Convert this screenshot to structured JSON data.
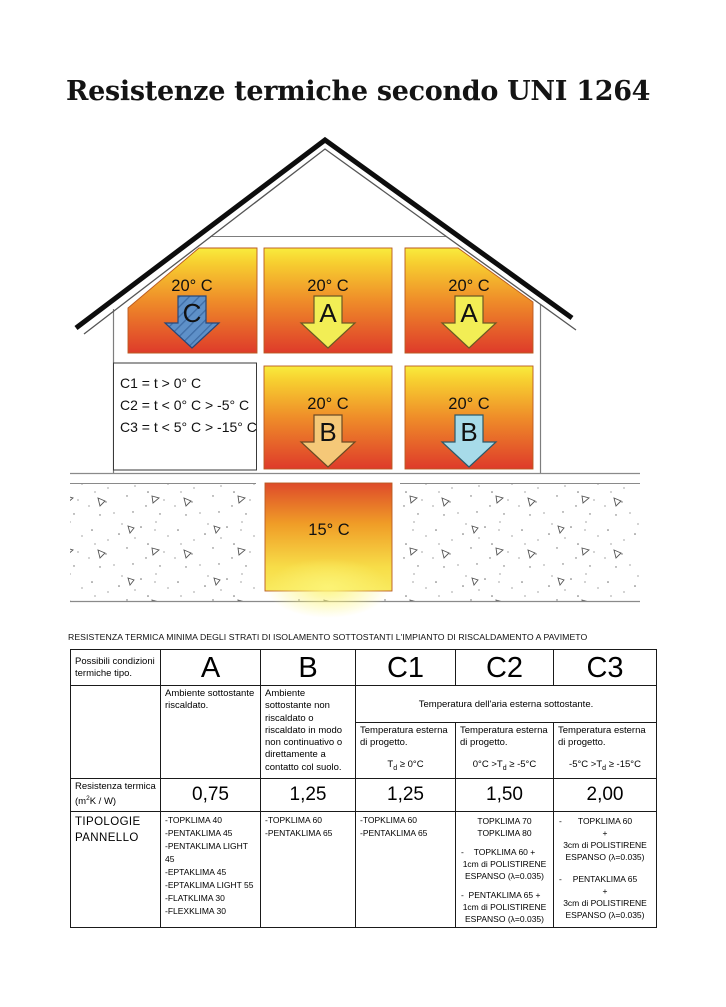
{
  "page": {
    "title": "Resistenze termiche secondo UNI 1264",
    "table_caption": "RESISTENZA TERMICA MINIMA DEGLI STRATI DI ISOLAMENTO SOTTOSTANTI L'IMPIANTO DI RISCALDAMENTO A PAVIMETO"
  },
  "diagram": {
    "legend_lines": {
      "l1": "C1 = t > 0° C",
      "l2": "C2 = t < 0° C > -5° C",
      "l3": "C3 = t < 5° C > -15° C"
    },
    "rooms": {
      "top_left_temp": "20° C",
      "top_left_arrow": "C",
      "top_mid_temp": "20° C",
      "top_mid_arrow": "A",
      "top_right_temp": "20° C",
      "top_right_arrow": "A",
      "mid_mid_temp": "20° C",
      "mid_mid_arrow": "B",
      "mid_right_temp": "20° C",
      "mid_right_arrow": "B",
      "cellar_temp": "15° C"
    },
    "colors": {
      "room_gradient_top": "#f9ec3d",
      "room_gradient_bottom": "#de3b2a",
      "arrow_c_blue": "#5e90c8",
      "arrow_a_yellow": "#f2ee55",
      "arrow_b_orange": "#f5c878",
      "arrow_b_lightblue": "#a7dbe9"
    }
  },
  "table": {
    "header_label": "Possibili condizioni termiche tipo.",
    "columns": [
      "A",
      "B",
      "C1",
      "C2",
      "C3"
    ],
    "cond_A": "Ambiente sottostante riscaldato.",
    "cond_B": "Ambiente sottostante non riscaldato o riscaldato in modo non continuativo o direttamente a contatto col suolo.",
    "cond_C_header": "Temperatura dell'aria esterna sottostante.",
    "cond_C_label": "Temperatura esterna di progetto.",
    "formulas": {
      "C1": {
        "pre": "T",
        "sub": "d",
        "post": " ≥ 0°C"
      },
      "C2": {
        "pre": "0°C >T",
        "sub": "d",
        "post": " ≥ -5°C"
      },
      "C3": {
        "pre": "-5°C >T",
        "sub": "d",
        "post": " ≥ -15°C"
      }
    },
    "resistance_label_line1": "Resistenza termica",
    "resistance_label_pre": "(m",
    "resistance_label_sup": "2",
    "resistance_label_post": "K / W)",
    "resistance_values": [
      "0,75",
      "1,25",
      "1,25",
      "1,50",
      "2,00"
    ],
    "typ_label_line1": "TIPOLOGIE",
    "typ_label_line2": "PANNELLO",
    "typ_A": [
      "-TOPKLIMA 40",
      "-PENTAKLIMA 45",
      "-PENTAKLIMA LIGHT 45",
      "-EPTAKLIMA 45",
      "-EPTAKLIMA LIGHT 55",
      "-FLATKLIMA 30",
      "-FLEXKLIMA 30"
    ],
    "typ_B": [
      "-TOPKLIMA 60",
      "-PENTAKLIMA 65"
    ],
    "typ_C1": [
      "-TOPKLIMA 60",
      "-PENTAKLIMA 65"
    ],
    "typ_C2": [
      {
        "dash": "",
        "lines": [
          "TOPKLIMA 70",
          "TOPKLIMA 80"
        ]
      },
      {
        "dash": "-",
        "lines": [
          "TOPKLIMA 60 +",
          "1cm di POLISTIRENE",
          "ESPANSO (λ=0.035)"
        ]
      },
      {
        "dash": "-",
        "lines": [
          "PENTAKLIMA 65 +",
          "1cm di POLISTIRENE",
          "ESPANSO (λ=0.035)"
        ]
      }
    ],
    "typ_C3": [
      {
        "dash": "-",
        "lines": [
          "TOPKLIMA 60",
          "+",
          "3cm di POLISTIRENE",
          "ESPANSO (λ=0.035)"
        ]
      },
      {
        "dash": "-",
        "lines": [
          "PENTAKLIMA 65",
          "+",
          "3cm di POLISTIRENE",
          "ESPANSO (λ=0.035)"
        ]
      }
    ]
  }
}
